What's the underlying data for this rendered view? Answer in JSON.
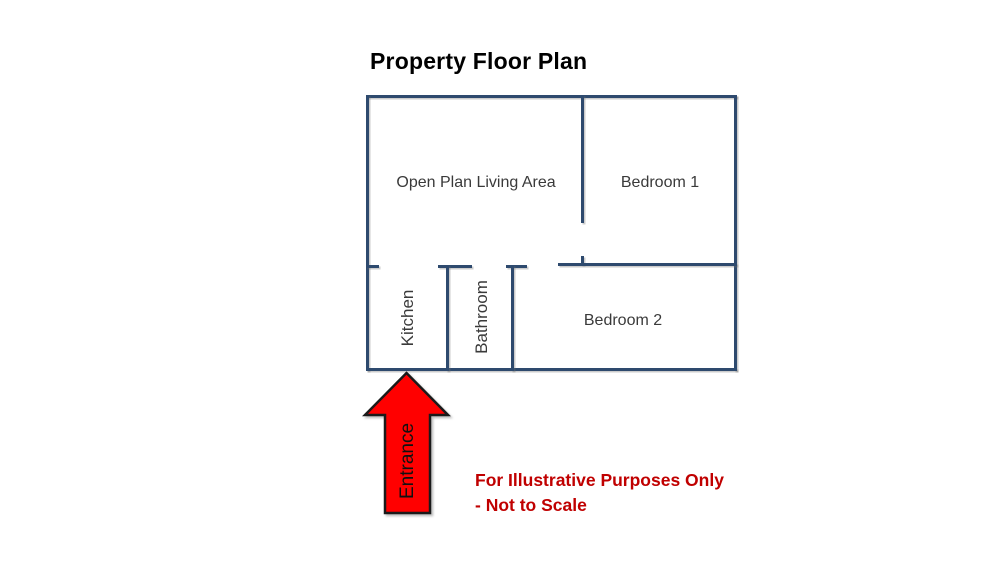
{
  "title": "Property Floor Plan",
  "colors": {
    "background": "#FFFFFF",
    "wall": "#2E4A6E",
    "room_label": "#3A3A3A",
    "title": "#000000",
    "arrow_fill": "#FF0000",
    "arrow_outline": "#1A1A1A",
    "disclaimer": "#C00000"
  },
  "rooms": [
    {
      "label": "Open Plan Living Area"
    },
    {
      "label": "Bedroom 1"
    },
    {
      "label": "Kitchen"
    },
    {
      "label": "Bathroom"
    },
    {
      "label": "Bedroom 2"
    }
  ],
  "entrance_label": "Entrance",
  "disclaimer": {
    "line1": "For Illustrative Purposes Only",
    "line2": "- Not to Scale"
  }
}
